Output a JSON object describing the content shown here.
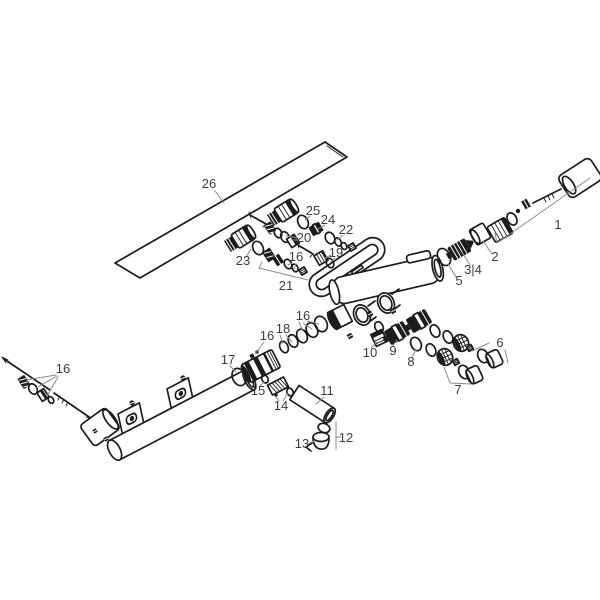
{
  "figure": {
    "type": "exploded-parts-diagram",
    "subject": "thermostatic-shower-mixer",
    "background": "#ffffff",
    "ink_color": "#1c1c1c",
    "leader_color": "#8a8a8a",
    "label_color": "#3d3d3d"
  },
  "labels": [
    {
      "text": "26"
    },
    {
      "text": "1"
    },
    {
      "text": "2"
    },
    {
      "text": "3|4"
    },
    {
      "text": "5"
    },
    {
      "text": "6"
    },
    {
      "text": "7"
    },
    {
      "text": "8"
    },
    {
      "text": "9"
    },
    {
      "text": "10"
    },
    {
      "text": "11"
    },
    {
      "text": "12"
    },
    {
      "text": "13"
    },
    {
      "text": "14"
    },
    {
      "text": "15"
    },
    {
      "text": "16"
    },
    {
      "text": "17"
    },
    {
      "text": "18"
    },
    {
      "text": "16"
    },
    {
      "text": "16"
    },
    {
      "text": "16"
    },
    {
      "text": "19"
    },
    {
      "text": "20"
    },
    {
      "text": "21"
    },
    {
      "text": "22"
    },
    {
      "text": "23"
    },
    {
      "text": "24"
    },
    {
      "text": "25"
    }
  ]
}
